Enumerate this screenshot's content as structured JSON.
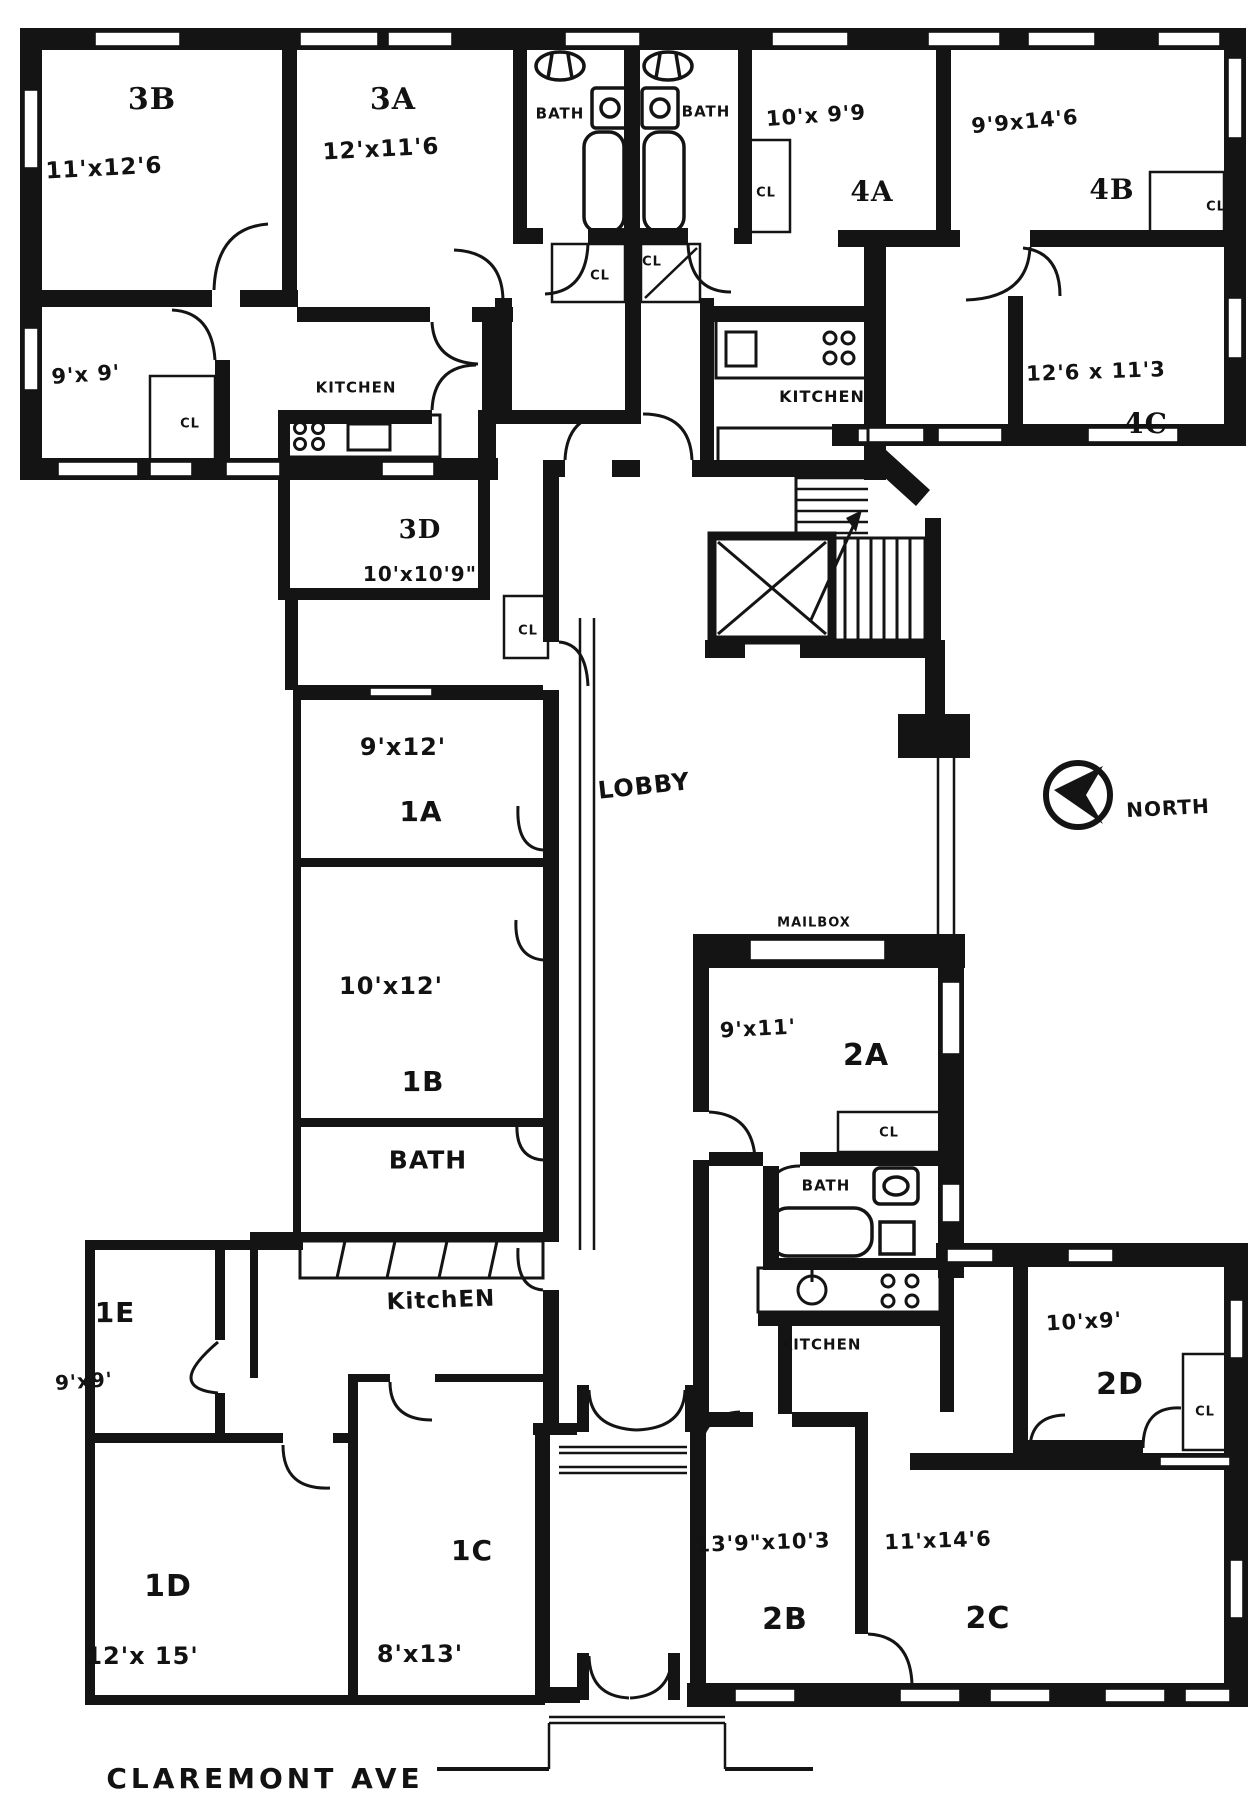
{
  "drawing": {
    "type": "apartment-building-floor-plan",
    "street": "CLAREMONT AVE",
    "north_indicator": "NORTH"
  },
  "rooms": [
    {
      "unit": "3B",
      "dimensions": "11'x12'6"
    },
    {
      "unit": "3A",
      "dimensions": "12'x11'6"
    },
    {
      "unit": "3D",
      "dimens ions": "10'x10'9\""
    },
    {
      "unit": "4A",
      "dimensions": "10'x9'9"
    },
    {
      "unit": "4B",
      "dimensions": "9'9x14'6"
    },
    {
      "unit": "4C",
      "dimensions": "12'6x11'3"
    },
    {
      "unit": "1A",
      "dimensions": "9'x12'"
    },
    {
      "unit": "1B",
      "dimensions": "10'x12'"
    },
    {
      "unit": "1C",
      "dimensions": "8'x13'"
    },
    {
      "unit": "1D",
      "dimensions": "12'x15'"
    },
    {
      "unit": "1E",
      "dimensions": "9'x9'"
    },
    {
      "unit": "2A",
      "dimensions": "9'x11'"
    },
    {
      "unit": "2B",
      "dimensions": "13'9\"x10'3"
    },
    {
      "unit": "2C",
      "dimensions": "11'x14'6"
    },
    {
      "unit": "2D",
      "dimensions": "10'x9'"
    }
  ],
  "labels": [
    {
      "id": "room-3b",
      "text": "3B",
      "x": 152,
      "y": 100,
      "size": 30,
      "cls": "print"
    },
    {
      "id": "dim-3b",
      "text": "11'x12'6",
      "x": 104,
      "y": 169,
      "size": 23,
      "cls": "hand",
      "rot": -3
    },
    {
      "id": "room-3a",
      "text": "3A",
      "x": 393,
      "y": 100,
      "size": 30,
      "cls": "print"
    },
    {
      "id": "dim-3a",
      "text": "12'x11'6",
      "x": 381,
      "y": 150,
      "size": 23,
      "cls": "hand",
      "rot": -3
    },
    {
      "id": "bath-3-left",
      "text": "BATH",
      "x": 560,
      "y": 114,
      "size": 15,
      "cls": "hand"
    },
    {
      "id": "bath-3-right",
      "text": "BATH",
      "x": 706,
      "y": 112,
      "size": 15,
      "cls": "hand"
    },
    {
      "id": "dim-4a",
      "text": "10'x 9'9",
      "x": 816,
      "y": 116,
      "size": 21,
      "cls": "hand",
      "rot": -4
    },
    {
      "id": "room-4a",
      "text": "4A",
      "x": 872,
      "y": 192,
      "size": 28,
      "cls": "print"
    },
    {
      "id": "dim-4b",
      "text": "9'9x14'6",
      "x": 1025,
      "y": 122,
      "size": 21,
      "cls": "hand",
      "rot": -5
    },
    {
      "id": "room-4b",
      "text": "4B",
      "x": 1112,
      "y": 190,
      "size": 28,
      "cls": "print"
    },
    {
      "id": "cl-4b",
      "text": "CL",
      "x": 1216,
      "y": 207,
      "size": 13,
      "cls": "hand"
    },
    {
      "id": "cl-4a",
      "text": "CL",
      "x": 766,
      "y": 193,
      "size": 13,
      "cls": "hand"
    },
    {
      "id": "cl-hall-left",
      "text": "CL",
      "x": 600,
      "y": 276,
      "size": 13,
      "cls": "hand"
    },
    {
      "id": "cl-hall-right",
      "text": "CL",
      "x": 652,
      "y": 262,
      "size": 13,
      "cls": "hand"
    },
    {
      "id": "kitchen-3",
      "text": "KITCHEN",
      "x": 356,
      "y": 388,
      "size": 15,
      "cls": "hand"
    },
    {
      "id": "cl-kitchen-3",
      "text": "CL",
      "x": 190,
      "y": 424,
      "size": 13,
      "cls": "hand"
    },
    {
      "id": "dim-9x9-3",
      "text": "9'x 9'",
      "x": 86,
      "y": 375,
      "size": 21,
      "cls": "hand",
      "rot": -4
    },
    {
      "id": "kitchen-4",
      "text": "KITCHEN",
      "x": 822,
      "y": 397,
      "size": 16,
      "cls": "hand"
    },
    {
      "id": "dim-4c",
      "text": "12'6 x 11'3",
      "x": 1096,
      "y": 372,
      "size": 21,
      "cls": "hand",
      "rot": -2
    },
    {
      "id": "room-4c",
      "text": "4C",
      "x": 1146,
      "y": 424,
      "size": 28,
      "cls": "print"
    },
    {
      "id": "room-3d",
      "text": "3D",
      "x": 420,
      "y": 530,
      "size": 26,
      "cls": "print"
    },
    {
      "id": "dim-3d",
      "text": "10'x10'9\"",
      "x": 420,
      "y": 574,
      "size": 20,
      "cls": "hand"
    },
    {
      "id": "cl-3d",
      "text": "CL",
      "x": 528,
      "y": 631,
      "size": 13,
      "cls": "hand"
    },
    {
      "id": "dim-1a",
      "text": "9'x12'",
      "x": 403,
      "y": 747,
      "size": 24,
      "cls": "hand"
    },
    {
      "id": "room-1a",
      "text": "1A",
      "x": 421,
      "y": 812,
      "size": 28,
      "cls": "hand"
    },
    {
      "id": "lobby",
      "text": "LOBBY",
      "x": 644,
      "y": 786,
      "size": 24,
      "cls": "hand",
      "rot": -6
    },
    {
      "id": "north",
      "text": "NORTH",
      "x": 1168,
      "y": 808,
      "size": 20,
      "cls": "hand",
      "rot": -3
    },
    {
      "id": "dim-1b",
      "text": "10'x12'",
      "x": 391,
      "y": 986,
      "size": 24,
      "cls": "hand"
    },
    {
      "id": "room-1b",
      "text": "1B",
      "x": 423,
      "y": 1082,
      "size": 28,
      "cls": "hand"
    },
    {
      "id": "mailbox",
      "text": "MAILBOX",
      "x": 814,
      "y": 923,
      "size": 13,
      "cls": "hand"
    },
    {
      "id": "dim-2a",
      "text": "9'x11'",
      "x": 758,
      "y": 1029,
      "size": 21,
      "cls": "hand",
      "rot": -3
    },
    {
      "id": "room-2a",
      "text": "2A",
      "x": 866,
      "y": 1056,
      "size": 30,
      "cls": "hand"
    },
    {
      "id": "cl-2a",
      "text": "CL",
      "x": 889,
      "y": 1133,
      "size": 13,
      "cls": "hand"
    },
    {
      "id": "bath-1",
      "text": "BATH",
      "x": 428,
      "y": 1160,
      "size": 25,
      "cls": "hand"
    },
    {
      "id": "bath-2",
      "text": "BATH",
      "x": 826,
      "y": 1186,
      "size": 15,
      "cls": "hand"
    },
    {
      "id": "kitchen-1",
      "text": "KitchEN",
      "x": 441,
      "y": 1301,
      "size": 23,
      "cls": "hand",
      "rot": -2
    },
    {
      "id": "kitchen-2",
      "text": "KITCHEN",
      "x": 821,
      "y": 1345,
      "size": 15,
      "cls": "hand"
    },
    {
      "id": "room-1e",
      "text": "1E",
      "x": 115,
      "y": 1313,
      "size": 28,
      "cls": "hand"
    },
    {
      "id": "dim-1e",
      "text": "9'x9'",
      "x": 84,
      "y": 1381,
      "size": 20,
      "cls": "hand",
      "rot": -4
    },
    {
      "id": "dim-2d",
      "text": "10'x9'",
      "x": 1084,
      "y": 1322,
      "size": 21,
      "cls": "hand",
      "rot": -3
    },
    {
      "id": "room-2d",
      "text": "2D",
      "x": 1120,
      "y": 1385,
      "size": 30,
      "cls": "hand"
    },
    {
      "id": "cl-2d",
      "text": "CL",
      "x": 1205,
      "y": 1412,
      "size": 13,
      "cls": "hand"
    },
    {
      "id": "dim-2b",
      "text": "13'9\"x10'3",
      "x": 763,
      "y": 1543,
      "size": 21,
      "cls": "hand",
      "rot": -2
    },
    {
      "id": "room-2b",
      "text": "2B",
      "x": 785,
      "y": 1620,
      "size": 30,
      "cls": "hand"
    },
    {
      "id": "dim-2c",
      "text": "11'x14'6",
      "x": 938,
      "y": 1541,
      "size": 21,
      "cls": "hand",
      "rot": -2
    },
    {
      "id": "room-2c",
      "text": "2C",
      "x": 988,
      "y": 1619,
      "size": 30,
      "cls": "hand"
    },
    {
      "id": "room-1d",
      "text": "1D",
      "x": 168,
      "y": 1587,
      "size": 30,
      "cls": "hand"
    },
    {
      "id": "dim-1d",
      "text": "12'x 15'",
      "x": 142,
      "y": 1656,
      "size": 24,
      "cls": "hand"
    },
    {
      "id": "room-1c",
      "text": "1C",
      "x": 472,
      "y": 1551,
      "size": 28,
      "cls": "hand"
    },
    {
      "id": "dim-1c",
      "text": "8'x13'",
      "x": 420,
      "y": 1654,
      "size": 24,
      "cls": "hand"
    },
    {
      "id": "street",
      "text": "CLAREMONT AVE",
      "x": 265,
      "y": 1779,
      "size": 28,
      "cls": "hand street"
    }
  ]
}
